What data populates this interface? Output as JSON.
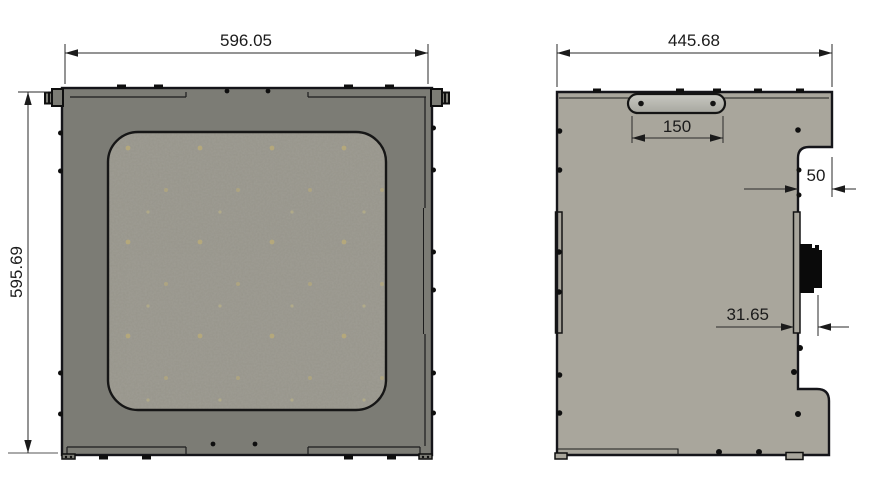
{
  "views": {
    "front": {
      "width": "596.05",
      "height": "595.69"
    },
    "side": {
      "width": "445.68",
      "handle_slot_width": "150",
      "notch_depth": "50",
      "connector_offset": "31.65"
    }
  },
  "colors": {
    "front_panel_fill": "#7c7c75",
    "mesh_fill": "#97958b",
    "side_panel_fill": "#a9a69c",
    "handle_fill": "#bdbdb7",
    "line": "#1b1b1b"
  }
}
